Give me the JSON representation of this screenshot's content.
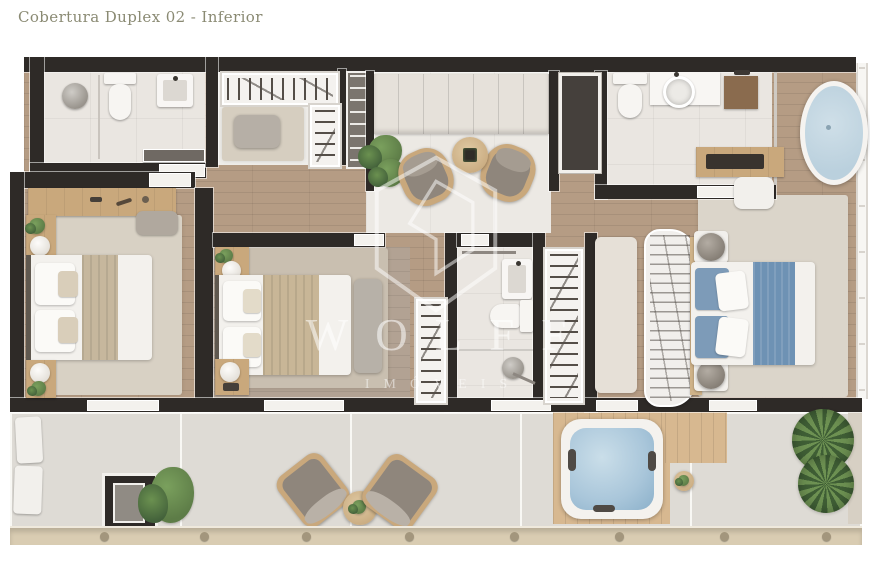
{
  "title": "Cobertura Duplex 02 - Inferior",
  "watermark": {
    "brand": "WOLFF",
    "tagline": "IMÓVEIS"
  },
  "colors": {
    "wall": "#2e2a27",
    "title_text": "#8a8a73",
    "wood": "#b59c84",
    "bedroom_floor": "#b2a293",
    "bath": "#eae6e1",
    "closet_floor": "#efede9",
    "living_floor": "#ece9e4",
    "terrace": "#dedbd5",
    "deck": "#d7b890",
    "railing": "#d9ccb2",
    "rug_light": "#d8d1c4",
    "rug_mid": "#c9bfb0",
    "rug_master": "#dbd5ca",
    "bed_white": "#f3f1ed",
    "throw_beige": "#c8b697",
    "blue_runner": "#6e92b4",
    "blue_pillow": "#7d9bb8",
    "tub_water": "#bad0dd",
    "spa_water": "#a9c6da",
    "furniture_wood": "#c9a87c",
    "cushion_gray": "#8f867c",
    "plant_green": "#5d7c47",
    "shower_mat": "#8a6b4e"
  }
}
